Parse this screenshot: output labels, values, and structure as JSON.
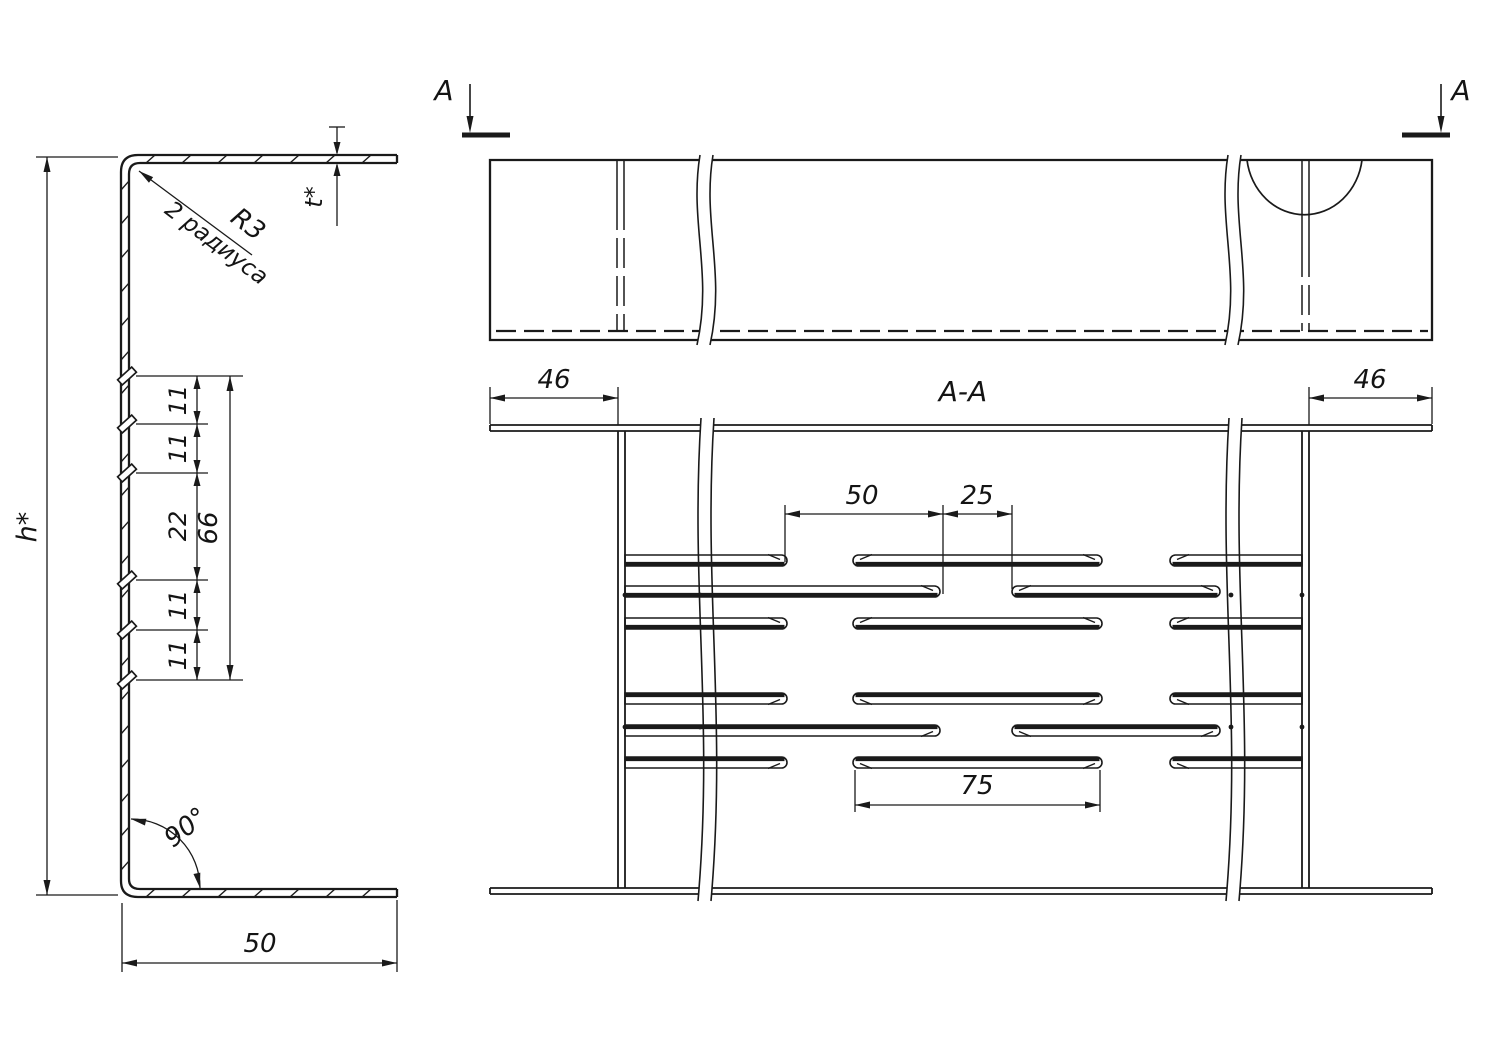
{
  "drawing": {
    "left_view": {
      "height_label": "h*",
      "thickness_label": "t*",
      "radius_label": "R3",
      "radius_note": "2 радиуса",
      "angle_label": "90°",
      "width_label": "50",
      "chain": [
        "11",
        "11",
        "22",
        "11",
        "11"
      ],
      "chain_total": "66"
    },
    "top_view": {
      "marker_left": "A",
      "marker_right": "A"
    },
    "section_view": {
      "title": "A-A",
      "flange_left": "46",
      "flange_right": "46",
      "slot_dim_50": "50",
      "slot_dim_25": "25",
      "slot_dim_75": "75"
    },
    "colors": {
      "line": "#1a1a1a",
      "background": "#ffffff"
    }
  }
}
